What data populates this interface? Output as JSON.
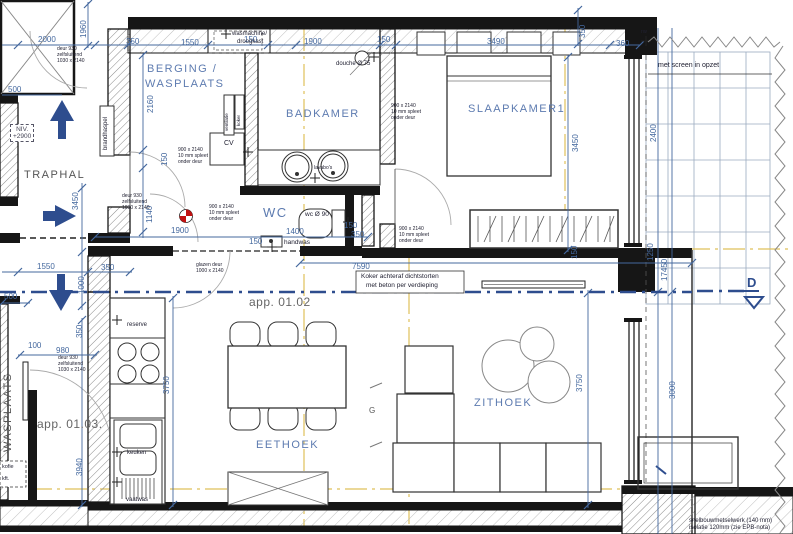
{
  "colors": {
    "dimension_blue": "#44689e",
    "room_label_blue": "#5d7bb0",
    "arrow_blue": "#2e4d8e",
    "centerline_yellow": "#dfc05a",
    "wall_black": "#161616",
    "marker_red": "#c11111"
  },
  "rooms": {
    "traphal": "TRAPHAL",
    "berging_l1": "BERGING /",
    "berging_l2": "WASPLAATS",
    "badkamer": "BADKAMER",
    "slaapkamer": "SLAAPKAMER1",
    "wc": "WC",
    "eethoek": "EETHOEK",
    "zithoek": "ZITHOEK",
    "wasplaats_v": "WASPLAATS"
  },
  "apartments": {
    "a0102": "app. 01.02",
    "a0103": "app. 01.03."
  },
  "dims_h": [
    "2000",
    "350",
    "1550",
    "150",
    "1900",
    "150",
    "3490",
    "360",
    "500",
    "1900",
    "150",
    "1400",
    "150",
    "350",
    "1550",
    "350",
    "7590",
    "500",
    "100",
    "980"
  ],
  "dims_v": [
    "1960",
    "3450",
    "2160",
    "150",
    "1140",
    "1000",
    "350",
    "3940",
    "3750",
    "350",
    "3450",
    "150",
    "3750",
    "2400",
    "1250",
    "17450",
    "3000"
  ],
  "notes": {
    "wasmachine_l1": "wasmachine/",
    "wasmachine_l2": "droogkast",
    "douche": "douche Ø 75",
    "deur930_l1": "deur 930",
    "deur930_l2": "zelfsluitend",
    "deur930_l3": "1030 x 2140",
    "spleet_l1": "900 x 2140",
    "spleet_l2": "10 mm spleet",
    "spleet_l3": "onder deur",
    "niv_l1": "NIV.",
    "niv_l2": "+2900",
    "brandhaspel": "brandhaspel",
    "ventilatie": "ventilatie",
    "koker": "koker",
    "cv": "CV",
    "lavabos": "lavabo's",
    "wc_d": "wc Ø 90",
    "handwas": "handwas",
    "glazen_l1": "glazen deur",
    "glazen_l2": "1000 x 2140",
    "koker_note_l1": "Koker achteraf dichtstorten",
    "koker_note_l2": "met beton per verdieping",
    "screen": "met screen in opzet",
    "reserve": "reserve",
    "keuken": "keuken",
    "vaatwas": "vaatwas",
    "wall_l1": "snelbouwmetselwerk (140 mm)",
    "wall_l2": "isolatie 120mm (zie EPB-nota)",
    "section_d": "D",
    "rw": "rw",
    "g": "G",
    "frag1": "kofie",
    "frag2": "kft."
  }
}
